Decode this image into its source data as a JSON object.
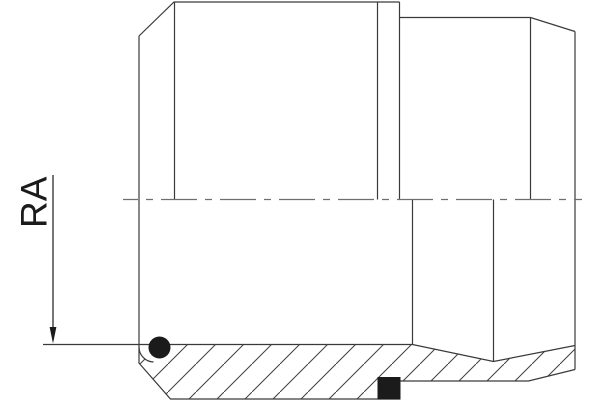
{
  "annotation": {
    "dimension_label": "RA"
  },
  "colors": {
    "outline": "#3a3a3a",
    "centerline": "#6f6f6f",
    "hatch": "#3f3f3f",
    "ink": "#1b1b1b",
    "background": "#ffffff"
  }
}
